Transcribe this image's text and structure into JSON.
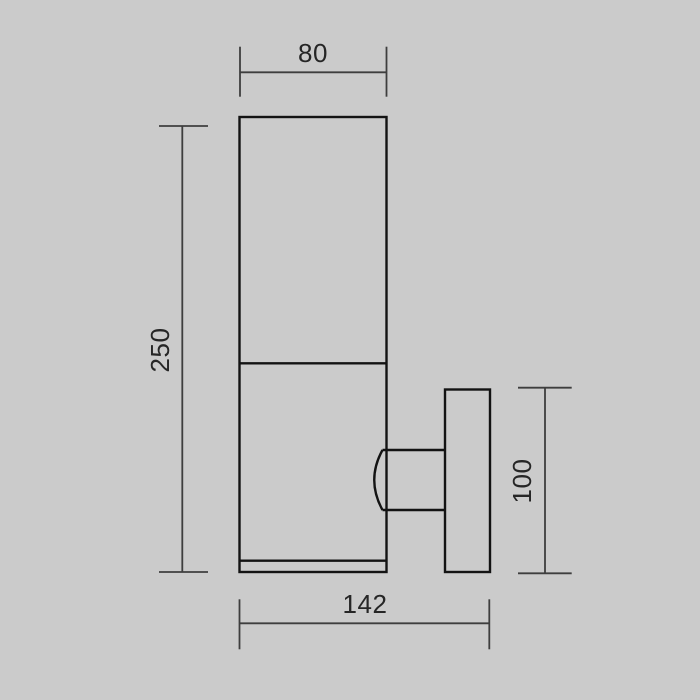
{
  "page": {
    "background_color": "#cbcbcb"
  },
  "drawing": {
    "object_line_color": "#131313",
    "dimension_line_color": "#3e3e3e",
    "text_color": "#262626",
    "labels": {
      "top_width": "80",
      "overall_height": "250",
      "bracket_height": "100",
      "overall_depth": "142"
    }
  }
}
